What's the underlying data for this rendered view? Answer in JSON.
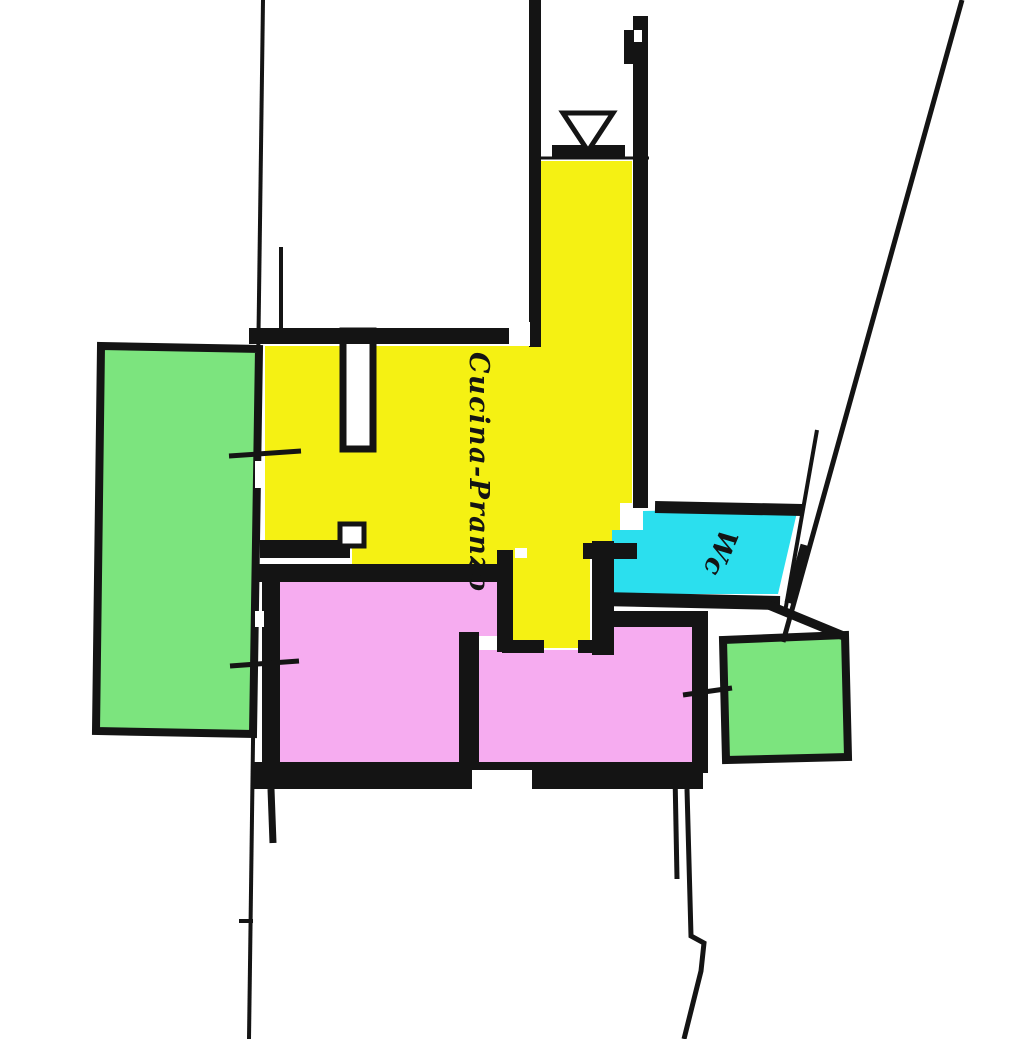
{
  "document": {
    "type": "scanned floor plan",
    "language": "Italian",
    "description": "Hand-drawn apartment plan with rooms highlighted in color"
  },
  "labels": {
    "kitchen_dining": "Cucina-Pranzo",
    "wc": "Wc"
  },
  "colors": {
    "kitchen_dining": "#F5F113",
    "bedrooms": "#F6ACF0",
    "balconies": "#7CE47E",
    "wc": "#2BDFEE",
    "walls": "#141414",
    "background": "#FFFFFF"
  },
  "rooms": [
    {
      "name": "balcony-left",
      "label": "",
      "color_key": "balconies"
    },
    {
      "name": "kitchen-dining",
      "label": "Cucina-Pranzo",
      "color_key": "kitchen_dining"
    },
    {
      "name": "bedroom-left",
      "label": "",
      "color_key": "bedrooms"
    },
    {
      "name": "bedroom-right",
      "label": "",
      "color_key": "bedrooms"
    },
    {
      "name": "wc",
      "label": "Wc",
      "color_key": "wc"
    },
    {
      "name": "balcony-right",
      "label": "",
      "color_key": "balconies"
    }
  ]
}
